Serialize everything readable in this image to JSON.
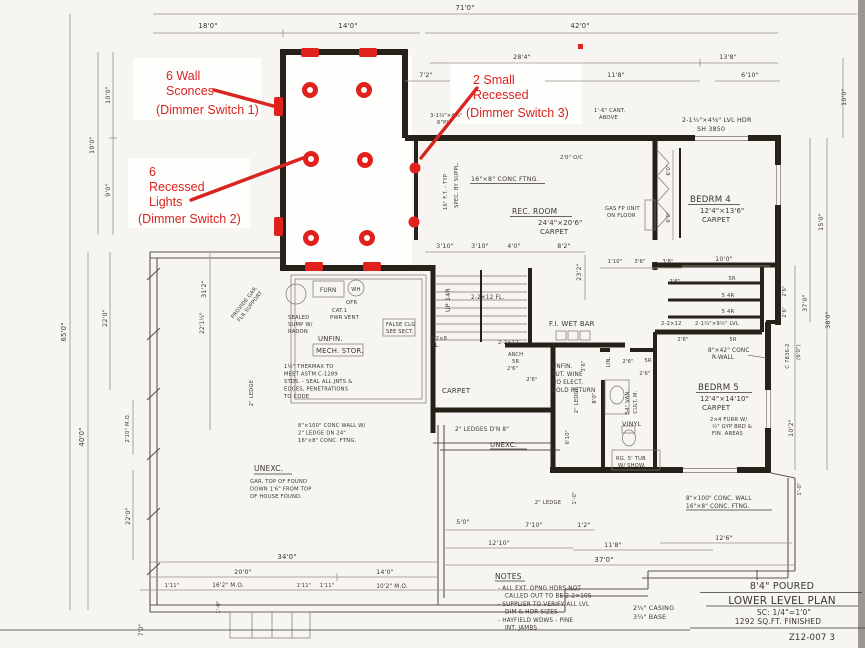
{
  "red": {
    "color": "#d92420",
    "sconce_l1": "6 Wall",
    "sconce_l2": "Sconces",
    "sconce_sw": "(Dimmer Switch 1)",
    "rec_l1": "6",
    "rec_l2": "Recessed",
    "rec_l3": "Lights",
    "rec_sw": "(Dimmer Switch 2)",
    "small_l1": "2 Small",
    "small_l2": "Recessed",
    "small_sw": "(Dimmer Switch 3)"
  },
  "title_block": {
    "line1": "8'4\" POURED",
    "line2": "LOWER LEVEL PLAN",
    "line3": "SC: 1/4\"=1'0\"",
    "line4": "1292 SQ.FT. FINISHED",
    "sheet": "Z12-007  3"
  },
  "notes": {
    "heading": "NOTES",
    "n1a": "- ALL EXT. OPNG HDRS NOT",
    "n1b": "CALLED OUT TO BE 2-2×10S",
    "n2a": "- SUPPLIER TO VERIFY ALL LVL",
    "n2b": "DIM & HDR SIZES",
    "n3a": "- HAYFIELD WDWS - PINE",
    "n3b": "INT. JAMBS",
    "casing": "2¼\" CASING",
    "base": "3¼\" BASE"
  },
  "rooms": {
    "rec1": "REC. ROOM",
    "rec2": "24'4\"×20'6\"",
    "rec3": "CARPET",
    "b41": "BEDRM 4",
    "b42": "12'4\"×13'6\"",
    "b43": "CARPET",
    "b51": "BEDRM 5",
    "b52": "12'4\"×14'10\"",
    "b53": "CARPET",
    "mech1": "UNFIN.",
    "mech2": "MECH. STOR.",
    "unexc1": "UNEXC.",
    "unexc2": "UNEXC.",
    "hallcarpet": "CARPET"
  },
  "labels": {
    "ftng": "16\"×8\" CONC FTNG.",
    "oc": "2'0\" O/C",
    "fttyp": "16\" F.T. - TYP",
    "spec": "SPEC. BY SUPPL.",
    "cant1": "1'-6\" CANT.",
    "cant2": "ABOVE",
    "hdr3": "3-1¾\"×4⅜\"",
    "plt": "6\"PL",
    "lvlhdr1": "2-1¾\"×4⅜\" LVL HDR",
    "lvlhdr2": "SH 3850",
    "gas1": "GAS FP UNIT",
    "gas2": "ON FLOOR",
    "lvl9": "2-1¾\"×9½\" LVL",
    "j12": "2-2×12",
    "jfl": "2-2×12 FL.",
    "j8a": "2-2×8",
    "j8b": "FL.",
    "j12b": "2-2×12",
    "rwall1": "8\"×42\" CONC",
    "rwall2": "R-WALL",
    "furr1": "2×4 FURR W/",
    "furr2": "½\" GYP BRD &",
    "furr3": "FIN. AREAS",
    "furn": "FURN",
    "wh": "WH",
    "ofr": "OFR",
    "cat1": "CAT.1",
    "cat2": "PWR VENT",
    "sump1": "SEALED",
    "sump2": "SUMP W/",
    "sump3": "RADON",
    "prov1": "PROVIDE GAR.",
    "prov2": "FLR SUPPORT",
    "thx1": "1½\" THERMAX TO",
    "thx2": "MEET ASTM C-1289",
    "thx3": "STDS. - SEAL ALL JNTS &",
    "thx4": "EDGES, PENETRATIONS",
    "thx5": "TO CODE",
    "up": "UP 14R",
    "arch1": "ARCH",
    "arch2": "5R",
    "arch3": "2'6\"",
    "wetbar": "F.I. WET BAR",
    "wine1": "UNFIN.",
    "wine2": "FUT. WINE",
    "wine3": "NO ELECT.",
    "wine4": "COLD RETURN",
    "falseclg1": "FALSE CLG",
    "falseclg2": "SEE SECT.",
    "ledge8": "2\" LEDGES D'N 8\"",
    "concL1": "8\"×100\" CONC WALL W/",
    "concL2": "2\" LEDGE DN 24\"",
    "concL3": "16\"×8\" CONC. FTNG.",
    "gartop1": "GAR. TOP OF FOUND",
    "gartop2": "DOWN 1'6\" FROM TOP",
    "gartop3": "OF HOUSE FOUND.",
    "concR1": "8\"×100\" CONC. WALL",
    "concR2": "16\"×8\" CONC. FTNG.",
    "van1": "54\" VAN.",
    "van2": "CULT. M.",
    "tub1": "RG. 5' TUB",
    "tub2": "W/ SHOW.",
    "vinyl": "VINYL",
    "lin": "LIN."
  },
  "dims": {
    "top71": "71'0\"",
    "top18": "18'0\"",
    "top14": "14'0\"",
    "top42": "42'0\"",
    "top28_4": "28'4\"",
    "top13_8": "13'8\"",
    "top7_2": "7'2\"",
    "top11_8": "11'8\"",
    "top6_10": "6'10\"",
    "l10": "10'0\"",
    "l9": "9'0\"",
    "l19": "19'0\"",
    "l65": "65'0\"",
    "l40": "40'0\"",
    "l22a": "22'0\"",
    "l22b": "22'0\"",
    "l31_2": "31'2\"",
    "l22_1": "22'1½\"",
    "l2_10": "2'10\" M.O.",
    "bl7": "7'0\"",
    "r10": "10'0\"",
    "r15": "15'0\"",
    "r37": "37'0\"",
    "r38": "38'0\"",
    "r2_6a": "2'6\"",
    "r2_6b": "2'6\"",
    "r6_0": "(6'0\")",
    "rcode": "C 7836-2",
    "r10_2": "10'2\"",
    "b34": "34'0\"",
    "b20": "20'0\"",
    "b14": "14'0\"",
    "b1_11a": "1'11\"",
    "b16_2": "16'2\" M.O.",
    "b1_11b": "1'11\"",
    "b1_11c": "1'11\"",
    "b10_2": "10'2\" M.O.",
    "b1_0a": "1'-0\"",
    "m5_0": "5'0\"",
    "m7_10": "7'10\"",
    "m1_2": "1'2\"",
    "m12_10": "12'10\"",
    "m11_8": "11'8\"",
    "m37": "37'0\"",
    "m12_6": "12'6\"",
    "m1_0b": "1'-0\"",
    "m1_0c": "1'-0\"",
    "s3_10a": "3'10\"",
    "s3_10b": "3'10\"",
    "s4_0": "4'0\"",
    "s8_2": "8'2\"",
    "s23_2": "23'2\"",
    "s1_10": "1'10\"",
    "s3_6": "3'6\"",
    "s3_8": "3'8\"",
    "s10_0": "10'0\"",
    "b4_6a": "6'0\"",
    "b4_6b": "6'0\"",
    "st2_6a": "2'6\"",
    "st5r1": "5R",
    "st54r1": "5 4R",
    "st54r2": "5 4R",
    "st2_6b": "2'6\"",
    "st5r2": "5R",
    "st2_6c": "2'6\"",
    "ba2_6a": "2'6\"",
    "ba5r": "5R",
    "ba2_6b": "2'6\"",
    "v6_10": "6'10\"",
    "v8_0": "8'0\"",
    "v3_6": "3'6\"",
    "ledgeva": "2\" LEDGE",
    "ledgevb": "2\" LEDGE",
    "ledgehc": "2\" LEDGE"
  }
}
